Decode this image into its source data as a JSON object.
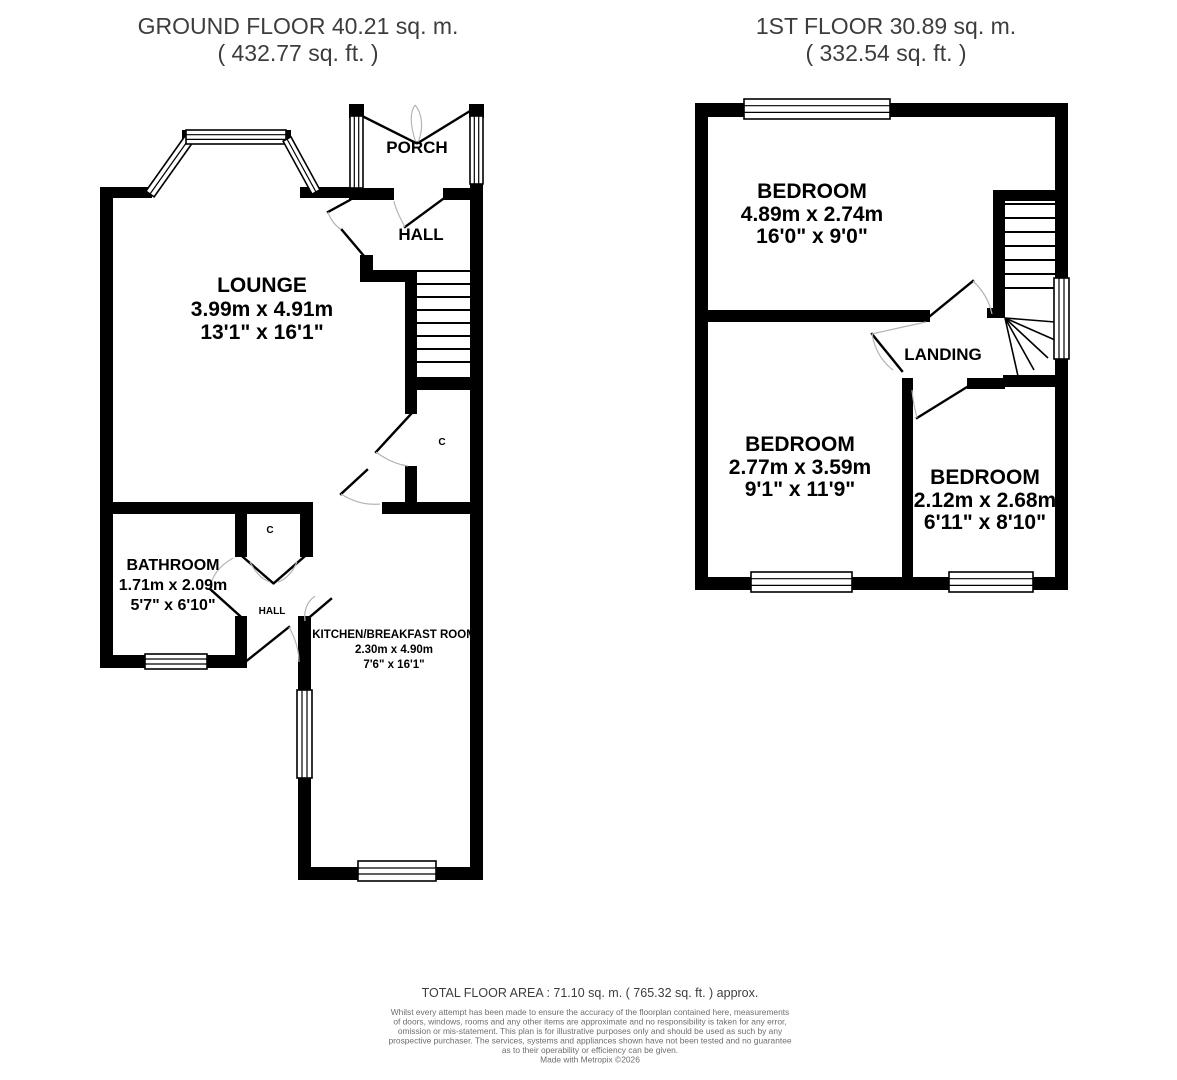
{
  "page": {
    "background": "#ffffff",
    "wall_color": "#000000"
  },
  "ground_floor": {
    "title": "GROUND FLOOR 40.21 sq. m.",
    "subtitle": "( 432.77 sq. ft. )",
    "rooms": {
      "porch": {
        "label": "PORCH"
      },
      "hall": {
        "label": "HALL"
      },
      "lounge": {
        "label": "LOUNGE",
        "size_metric": "3.99m x 4.91m",
        "size_imperial": "13'1\" x 16'1\""
      },
      "bathroom": {
        "label": "BATHROOM",
        "size_metric": "1.71m x 2.09m",
        "size_imperial": "5'7\" x 6'10\""
      },
      "kitchen": {
        "label": "KITCHEN/BREAKFAST ROOM",
        "size_metric": "2.30m x 4.90m",
        "size_imperial": "7'6\" x 16'1\""
      },
      "inner_hall": {
        "label": "HALL"
      },
      "cupboard_under_stairs": {
        "label": "C"
      },
      "cupboard_hall": {
        "label": "C"
      }
    }
  },
  "first_floor": {
    "title": "1ST FLOOR 30.89 sq. m.",
    "subtitle": "( 332.54 sq. ft. )",
    "rooms": {
      "bedroom1": {
        "label": "BEDROOM",
        "size_metric": "4.89m x 2.74m",
        "size_imperial": "16'0\" x 9'0\""
      },
      "bedroom2": {
        "label": "BEDROOM",
        "size_metric": "2.77m x 3.59m",
        "size_imperial": "9'1\" x 11'9\""
      },
      "bedroom3": {
        "label": "BEDROOM",
        "size_metric": "2.12m x 2.68m",
        "size_imperial": "6'11\" x 8'10\""
      },
      "landing": {
        "label": "LANDING"
      }
    }
  },
  "footer": {
    "total_area": "TOTAL FLOOR AREA : 71.10 sq. m. ( 765.32 sq. ft. ) approx.",
    "disclaimer_lines": [
      "Whilst every attempt has been made to ensure the accuracy of the floorplan contained here, measurements",
      "of doors, windows, rooms and any other items are approximate and no responsibility is taken for any error,",
      "omission or mis-statement. This plan is for illustrative purposes only and should be used as such by any",
      "prospective purchaser. The services, systems and appliances shown have not been tested and no guarantee",
      "as to their operability or efficiency can be given.",
      "Made with Metropix ©2026"
    ]
  }
}
